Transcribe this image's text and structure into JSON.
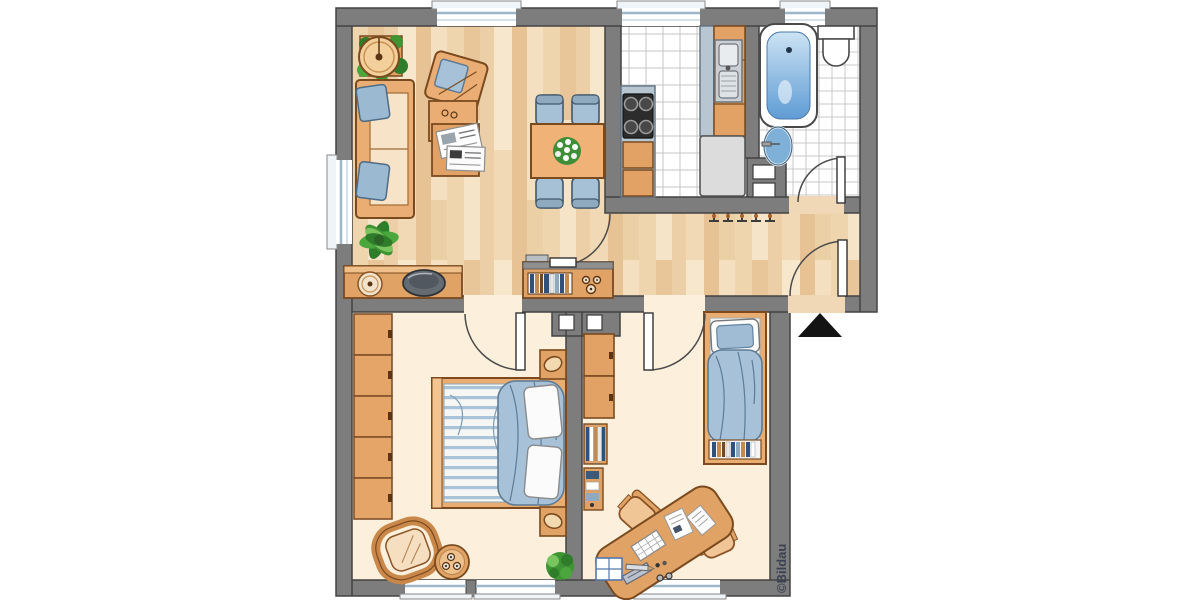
{
  "copyright": "©Bildau",
  "plan": {
    "type": "apartment floor plan, top-down view",
    "rooms": [
      {
        "name": "living-room",
        "floor": "wood-parquet",
        "furniture": [
          "sofa",
          "armchair",
          "coffee-table-with-magazines",
          "dining-table",
          "dining-chairs-x4",
          "flower-centerpiece",
          "round-side-table",
          "potted-plant-x2",
          "sideboard-with-plate-and-bowl"
        ]
      },
      {
        "name": "kitchen",
        "floor": "white-tile",
        "furniture": [
          "counter-left",
          "stove-4-burners",
          "base-cabinets",
          "counter-right",
          "double-sink",
          "refrigerator"
        ]
      },
      {
        "name": "bathroom",
        "floor": "white-tile",
        "furniture": [
          "bathtub",
          "toilet",
          "washbasin",
          "installation-shafts-x2"
        ]
      },
      {
        "name": "hallway",
        "floor": "wood-parquet",
        "furniture": [
          "wall-shelf-with-books",
          "decor-rings",
          "coat-hooks-x5"
        ]
      },
      {
        "name": "bedroom",
        "floor": "plain-cream",
        "furniture": [
          "wardrobe-5-sections",
          "double-bed",
          "nightstand-with-lamp-x2",
          "rattan-chair",
          "round-table-with-candles",
          "potted-plant"
        ]
      },
      {
        "name": "kids-room-office",
        "floor": "plain-cream",
        "furniture": [
          "cabinet",
          "wall-bookshelves",
          "single-bed",
          "book-row-at-foot",
          "desk-with-keyboard-and-papers",
          "office-chair-x2",
          "side-box",
          "pencil"
        ]
      }
    ],
    "doors": [
      "bedroom-door",
      "office-door",
      "entrance-door",
      "bathroom-door",
      "kitchen-door"
    ],
    "windows": [
      "living-top",
      "kitchen-top",
      "bathroom-top",
      "living-left",
      "bedroom-bottom-double",
      "office-bottom"
    ],
    "entrance_marker": "black-triangle-pointing-into-apartment"
  },
  "colors": {
    "wall": "#7d7d7d",
    "wall_outline": "#434343",
    "wood_floor": "#f2dcba",
    "room_floor": "#fcf0dc",
    "tile_grout": "#c6c6c6",
    "furniture_orange": "#e2a266",
    "furniture_outline": "#7a4a1f",
    "textile_blue": "#a7c2d8",
    "plant_green": "#4aa63d",
    "water_blue": "#6aa3d6",
    "counter_blue": "#b7c6d0",
    "entrance_arrow": "#141414",
    "copyright_text": "#3a4150"
  }
}
